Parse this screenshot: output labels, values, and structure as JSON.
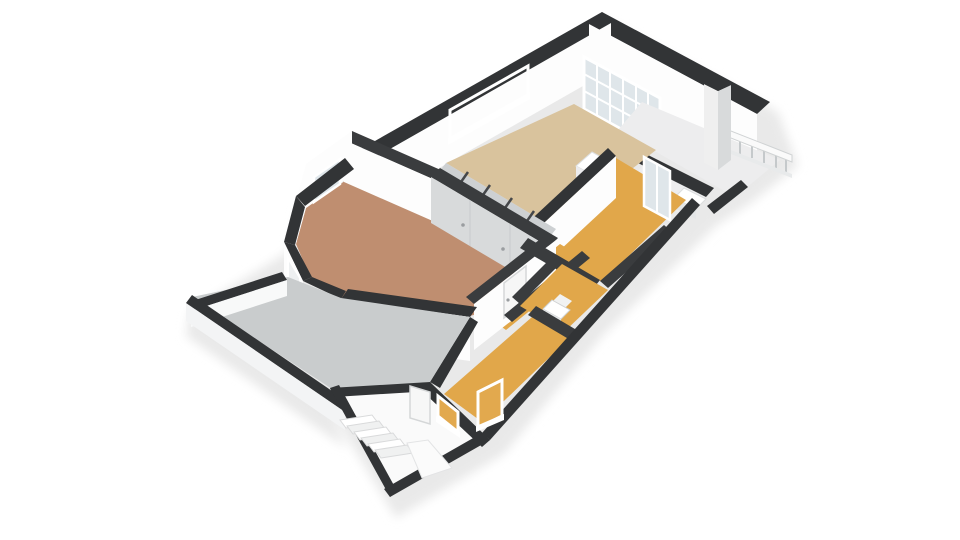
{
  "meta": {
    "view": "3d-floorplan-cutaway",
    "floor_label": "upper floor apartment",
    "background": "#ffffff"
  },
  "palette": {
    "wall_top": "#323436",
    "wall_top_inner": "#3a3c3e",
    "wall_face": "#fdfdfd",
    "wall_face_shade": "#ececee",
    "slab": "#f3f4f5",
    "shadow": "#e9e9e9",
    "closet_front": "#d8dadb",
    "niche": "#cdd0d2",
    "glass": "#dfe6ea",
    "glass_light": "#eef0f1",
    "glass_amber": "#e2a94e",
    "railing": "#fafafa",
    "railing_post": "#c5c9cb",
    "furniture": "#ffffff",
    "furniture_shade": "#e4e6e7",
    "step": "#f6f7f7",
    "step_edge": "#d9dadb"
  },
  "rooms": [
    {
      "id": "living-room",
      "name": "Living room (bay window)",
      "color": "#bf8e70"
    },
    {
      "id": "kitchen-dining",
      "name": "Kitchen / dining",
      "color": "#d9c39d"
    },
    {
      "id": "bedroom-front",
      "name": "Bedroom front",
      "color": "#e1a74a"
    },
    {
      "id": "toilet",
      "name": "Toilet",
      "color": "#e1a74a"
    },
    {
      "id": "bedroom-rear",
      "name": "Bedroom rear",
      "color": "#e1a74a"
    },
    {
      "id": "hallway",
      "name": "Hallway",
      "color": "#e1a74a"
    },
    {
      "id": "terrace",
      "name": "Roof terrace",
      "color": "#c9cccd"
    },
    {
      "id": "balcony",
      "name": "Balcony",
      "color": "#ededee"
    },
    {
      "id": "loggia",
      "name": "Loggia / porch",
      "color": "#ededee"
    },
    {
      "id": "stairwell",
      "name": "Stairwell",
      "color": "#fafafa"
    }
  ],
  "features": [
    "bay-window",
    "french-glazed-wall",
    "balcony-railing",
    "chimney",
    "built-in-closet",
    "staircase",
    "toilet-fixture",
    "kitchen-counter",
    "amber-glass-windows",
    "terrace-low-walls"
  ]
}
